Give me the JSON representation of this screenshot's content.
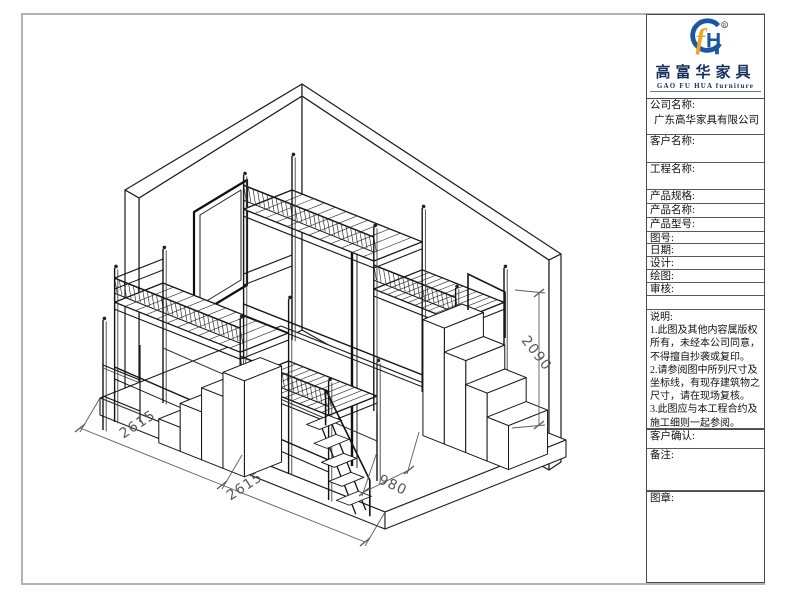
{
  "page": {
    "background": "#ffffff",
    "frame_color": "#b3b3b3"
  },
  "drawing": {
    "description": "isometric-view-of-dormitory-loft-bunk-beds-with-stairs",
    "dimensions": [
      {
        "id": "dim-2615-a",
        "value": "2615"
      },
      {
        "id": "dim-2615-b",
        "value": "2615"
      },
      {
        "id": "dim-980",
        "value": "980"
      },
      {
        "id": "dim-2090",
        "value": "2090"
      }
    ],
    "line_color": "#1c1c1c",
    "dim_color": "#5c5c5c"
  },
  "title_block": {
    "logo": {
      "brand_cn": "高富华家具",
      "brand_en": "GAO FU HUA furniture",
      "registered": "®",
      "mark_blue": "#1a57a0",
      "mark_orange": "#eda426"
    },
    "fields": [
      {
        "label": "公司名称:",
        "value": "广东高华家具有限公司"
      },
      {
        "label": "客户名称:",
        "value": ""
      },
      {
        "label": "工程名称:",
        "value": ""
      },
      {
        "label": "产品规格:",
        "value": ""
      },
      {
        "label": "产品名称:",
        "value": ""
      },
      {
        "label": "产品型号:",
        "value": ""
      },
      {
        "label": "图号:",
        "value": ""
      },
      {
        "label": "日期:",
        "value": ""
      },
      {
        "label": "设计:",
        "value": ""
      },
      {
        "label": "绘图:",
        "value": ""
      },
      {
        "label": "审核:",
        "value": ""
      }
    ],
    "notes": {
      "label": "说明:",
      "items": [
        "1.此图及其他内容属版权所有，未经本公司同意，不得擅自抄袭或复印。",
        "2.请参阅图中所列尺寸及坐标线，有现存建筑物之尺寸，请在现场复核。",
        "3.此图应与本工程合约及施工细则一起参阅。",
        "4.此图内容与以下工程合约有关。"
      ]
    },
    "footer": {
      "confirm_label": "客户确认:",
      "remark_label": "备注:",
      "seal_label": "图章:"
    }
  }
}
